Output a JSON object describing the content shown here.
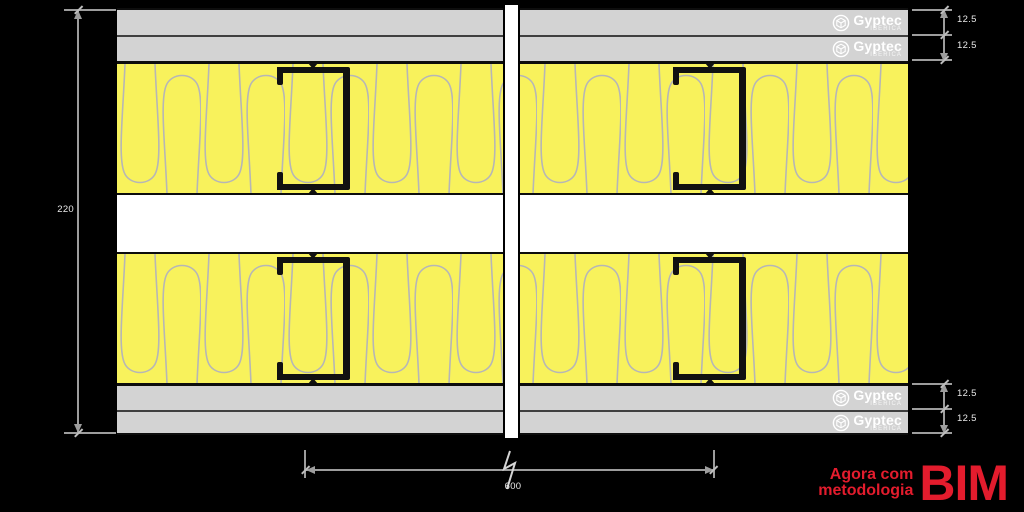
{
  "canvas": {
    "background": "#000000"
  },
  "brand": {
    "name": "Gyptec",
    "subtitle": "IBÉRICA"
  },
  "promo": {
    "line1": "Agora com",
    "line2": "metodologia",
    "acronym": "BIM",
    "color": "#e31c2d"
  },
  "dimension_labels": {
    "total_thickness": "220",
    "stud_spacing": "600",
    "top_boards": [
      "12.5",
      "12.5"
    ],
    "bottom_boards": [
      "12.5",
      "12.5"
    ]
  },
  "materials": {
    "plasterboard_color": "#d3d3d3",
    "insulation_color": "#f8f25c",
    "insulation_hatch_color": "#b6b6b6",
    "stud_color": "#111111",
    "cavity_color": "#ffffff",
    "dimension_line_color": "#9d9d9d",
    "dimension_text_color": "#e8e8e8"
  }
}
